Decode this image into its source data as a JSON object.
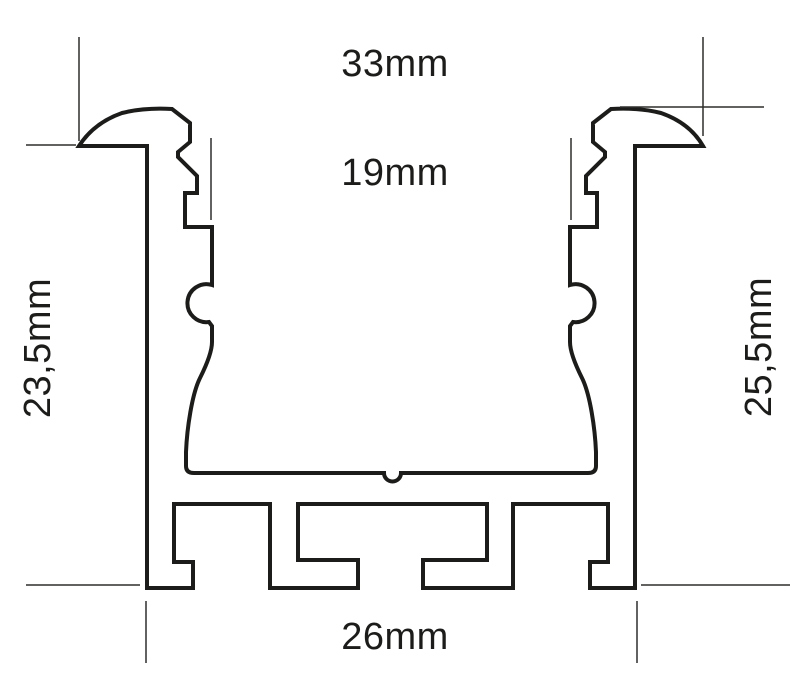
{
  "diagram": {
    "title": "Aluminium LED profile cross-section technical drawing",
    "background_color": "#ffffff",
    "line_color": "#1c1c1a",
    "dimensions": {
      "top_width": {
        "label": "33mm",
        "meaning": "overall width across top flanges"
      },
      "opening_width": {
        "label": "19mm",
        "meaning": "inner channel opening width"
      },
      "left_height": {
        "label": "23,5mm",
        "meaning": "recessed depth below flange"
      },
      "right_height": {
        "label": "25,5mm",
        "meaning": "overall height including flange"
      },
      "bottom_width": {
        "label": "26mm",
        "meaning": "body width at base"
      }
    }
  }
}
